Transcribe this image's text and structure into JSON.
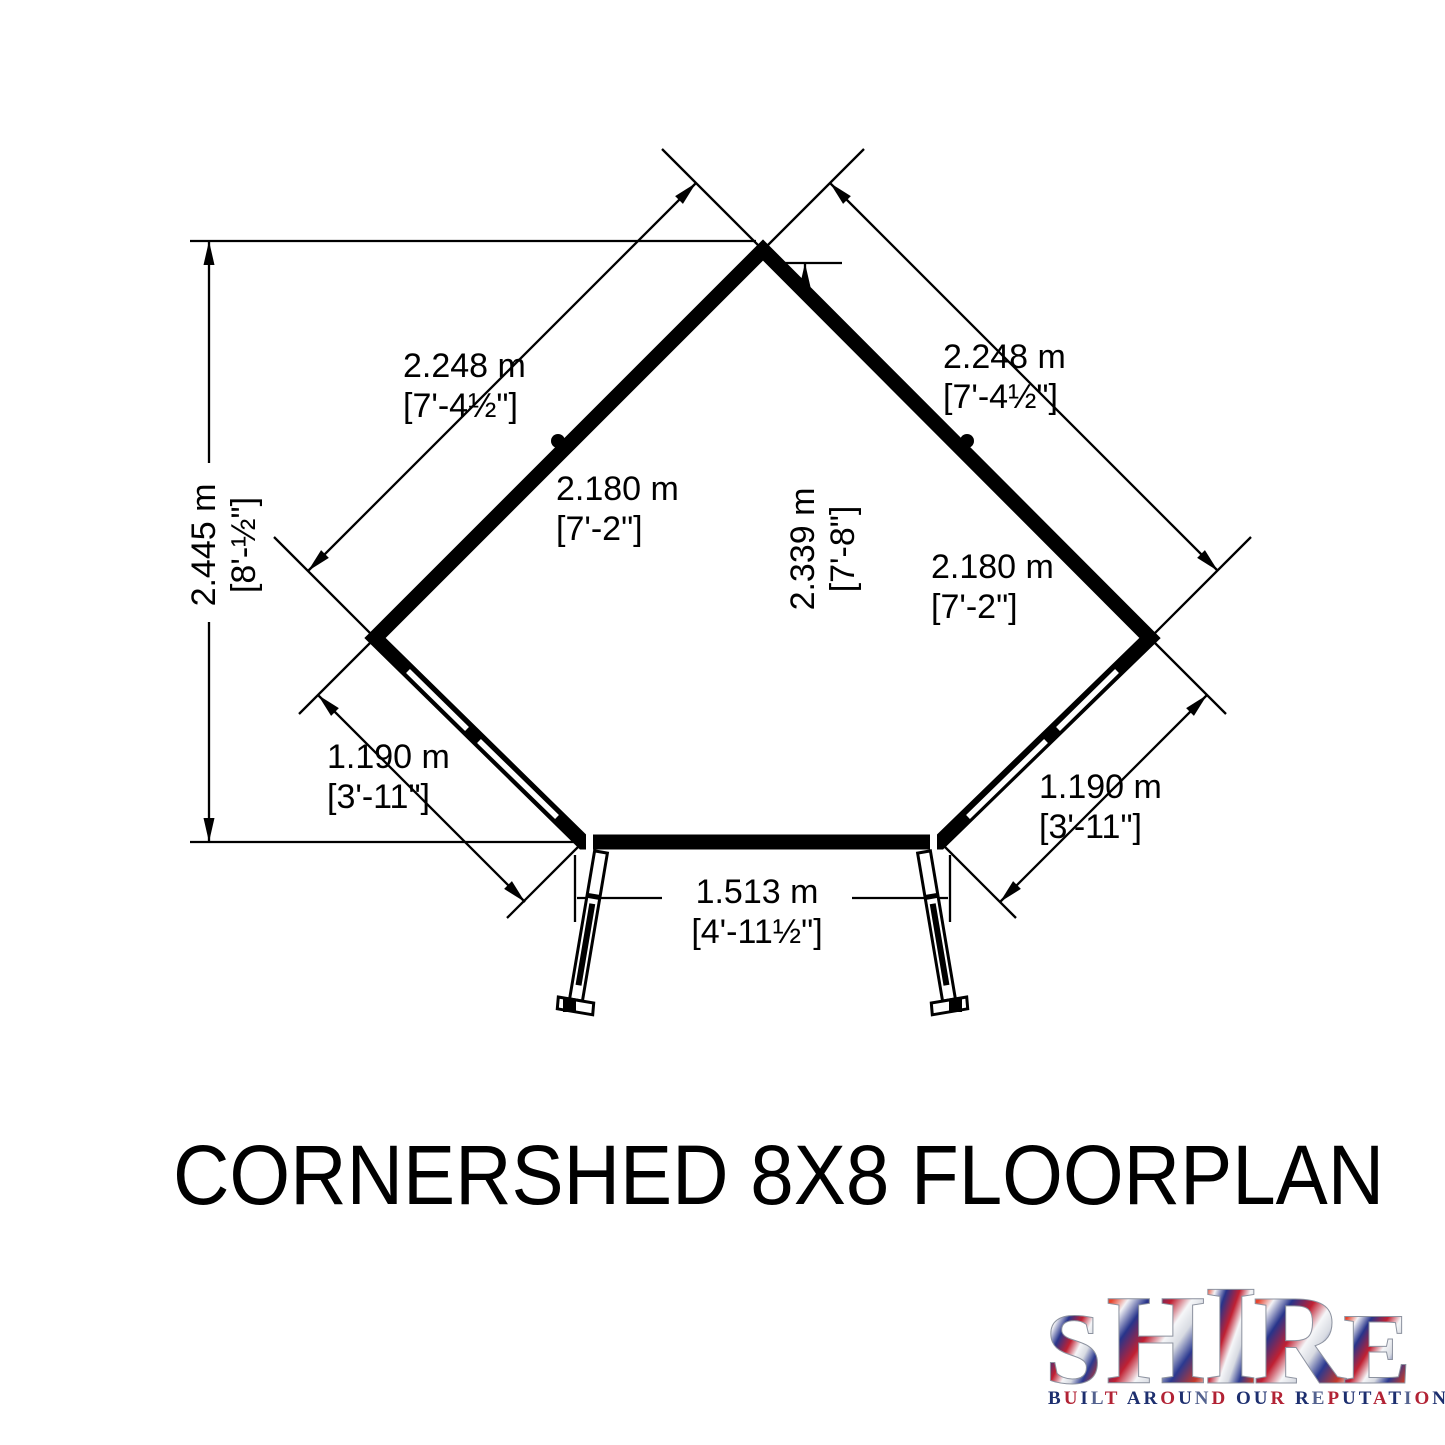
{
  "page": {
    "background": "#ffffff"
  },
  "diagram": {
    "title": "CORNERSHED 8X8 FLOORPLAN",
    "dimensions": {
      "overall_height_left": {
        "metric": "2.445 m",
        "imperial": "[8'-½\"]"
      },
      "wall_upper_left": {
        "metric": "2.248 m",
        "imperial": "[7'-4½\"]"
      },
      "wall_upper_right": {
        "metric": "2.248 m",
        "imperial": "[7'-4½\"]"
      },
      "internal_width_left": {
        "metric": "2.180 m",
        "imperial": "[7'-2\"]"
      },
      "internal_width_right": {
        "metric": "2.180 m",
        "imperial": "[7'-2\"]"
      },
      "internal_height_centre": {
        "metric": "2.339 m",
        "imperial": "[7'-8\"]"
      },
      "wall_lower_left": {
        "metric": "1.190 m",
        "imperial": "[3'-11\"]"
      },
      "wall_lower_right": {
        "metric": "1.190 m",
        "imperial": "[3'-11\"]"
      },
      "door_opening": {
        "metric": "1.513 m",
        "imperial": "[4'-11½\"]"
      }
    }
  },
  "logo": {
    "brand": "SHIRE",
    "tagline": "BUILT AROUND OUR REPUTATION",
    "tagline_palette": [
      "#1d2f6f",
      "#b22234",
      "#1d2f6f",
      "#53628f",
      "#b22234",
      "#1d2f6f"
    ],
    "flag_colors": {
      "red": "#c0392b",
      "navy": "#27348b",
      "silver": "#e8eaef"
    }
  }
}
